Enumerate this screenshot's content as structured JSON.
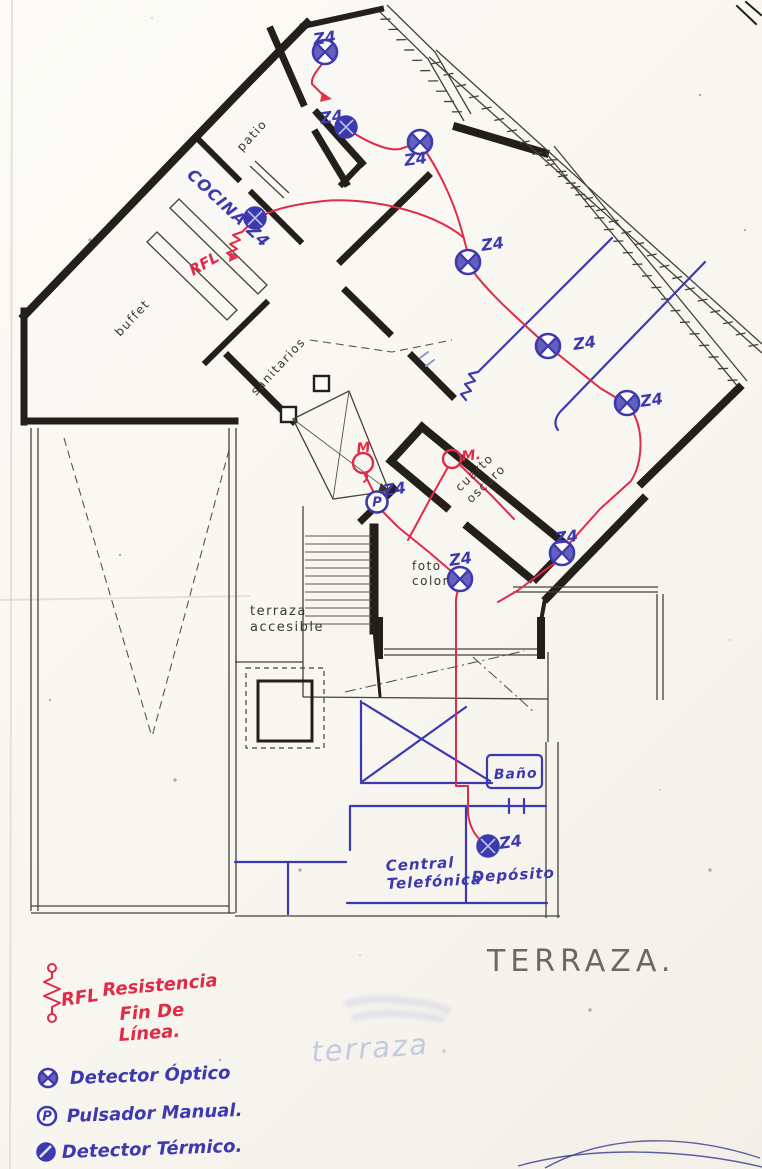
{
  "colors": {
    "wall": "#241f1a",
    "red_ink": "#e02b47",
    "blue_ink": "#3d39ae",
    "pencil": "#55504a",
    "faint_blue": "#a3b0d6"
  },
  "titles": {
    "terraza_pencil": "TERRAZA.",
    "terraza_faint": "terraza ."
  },
  "rooms": [
    {
      "name": "patio",
      "lines": [
        "patio"
      ],
      "x": 242,
      "y": 152,
      "rot": -47,
      "cls": "room",
      "size": 12,
      "lh": 14
    },
    {
      "name": "cocina",
      "lines": [
        "COCINA Z4"
      ],
      "x": 186,
      "y": 176,
      "rot": 43,
      "cls": "room-blue",
      "size": 16,
      "lh": 18
    },
    {
      "name": "buffet",
      "lines": [
        "buffet"
      ],
      "x": 120,
      "y": 337,
      "rot": -47,
      "cls": "room",
      "size": 12,
      "lh": 14
    },
    {
      "name": "sanitarios",
      "lines": [
        "sanitarios"
      ],
      "x": 256,
      "y": 396,
      "rot": -47,
      "cls": "room",
      "size": 12,
      "lh": 14
    },
    {
      "name": "cuarto-oscuro",
      "lines": [
        "cuarto",
        "oscuro"
      ],
      "x": 460,
      "y": 492,
      "rot": -44,
      "cls": "room",
      "size": 12,
      "lh": 16
    },
    {
      "name": "foto-color",
      "lines": [
        "foto",
        "color"
      ],
      "x": 412,
      "y": 570,
      "rot": 0,
      "cls": "room",
      "size": 12,
      "lh": 15
    },
    {
      "name": "terraza-accesible",
      "lines": [
        "terraza",
        "accesible"
      ],
      "x": 250,
      "y": 615,
      "rot": 0,
      "cls": "room",
      "size": 13,
      "lh": 16
    },
    {
      "name": "bano",
      "lines": [
        "Baño"
      ],
      "x": 494,
      "y": 779,
      "rot": -2,
      "cls": "room-blue",
      "size": 14,
      "lh": 16
    },
    {
      "name": "central-telefonica",
      "lines": [
        "Central",
        "Telefónica"
      ],
      "x": 386,
      "y": 871,
      "rot": -3,
      "cls": "room-blue",
      "size": 15,
      "lh": 18
    },
    {
      "name": "deposito",
      "lines": [
        "Depósito"
      ],
      "x": 472,
      "y": 882,
      "rot": -3,
      "cls": "room-blue",
      "size": 15,
      "lh": 18
    }
  ],
  "detectors": [
    {
      "type": "optical",
      "x": 325,
      "y": 52,
      "zone": "Z4",
      "zx": 314,
      "zy": 45
    },
    {
      "type": "solid",
      "x": 346,
      "y": 127,
      "zone": "Z4",
      "zx": 321,
      "zy": 124
    },
    {
      "type": "optical",
      "x": 420,
      "y": 142,
      "zone": "Z4",
      "zx": 405,
      "zy": 166
    },
    {
      "type": "solid",
      "x": 255,
      "y": 218,
      "zone": "",
      "zx": 0,
      "zy": 0
    },
    {
      "type": "optical",
      "x": 468,
      "y": 262,
      "zone": "Z4",
      "zx": 482,
      "zy": 251
    },
    {
      "type": "optical",
      "x": 548,
      "y": 346,
      "zone": "Z4",
      "zx": 574,
      "zy": 350
    },
    {
      "type": "optical",
      "x": 627,
      "y": 403,
      "zone": "Z4",
      "zx": 641,
      "zy": 407
    },
    {
      "type": "optical",
      "x": 562,
      "y": 553,
      "zone": "Z4",
      "zx": 556,
      "zy": 544
    },
    {
      "type": "optical",
      "x": 460,
      "y": 579,
      "zone": "Z4",
      "zx": 450,
      "zy": 566
    },
    {
      "type": "solid",
      "x": 488,
      "y": 846,
      "zone": "Z4",
      "zx": 500,
      "zy": 849
    },
    {
      "type": "pulsador",
      "x": 377,
      "y": 502,
      "zone": "Z4",
      "zx": 384,
      "zy": 496
    }
  ],
  "red_marks": [
    {
      "type": "circle-tail",
      "x": 363,
      "y": 463,
      "label": "M",
      "lx": 357,
      "ly": 453
    },
    {
      "type": "circle",
      "x": 452,
      "y": 459,
      "label": "M.",
      "lx": 462,
      "ly": 461
    }
  ],
  "rfl_note": {
    "label": "RFL",
    "x": 193,
    "y": 276,
    "rot": -30
  },
  "legend": {
    "items": [
      {
        "name": "rfl",
        "symbol": "rfl",
        "color": "red",
        "sx": 52,
        "sy": 996,
        "code": "RFL",
        "cx": 62,
        "cy": 1006,
        "lines": [
          {
            "t": "Resistencia",
            "x": 103,
            "y": 996,
            "r": -5
          },
          {
            "t": "Fin De",
            "x": 120,
            "y": 1020,
            "r": -4
          },
          {
            "t": "Línea.",
            "x": 119,
            "y": 1041,
            "r": -4
          }
        ]
      },
      {
        "name": "detector-optico",
        "symbol": "circle-x",
        "color": "blue",
        "sx": 48,
        "sy": 1078,
        "lines": [
          {
            "t": "Detector Óptico",
            "x": 70,
            "y": 1084,
            "r": -2
          }
        ]
      },
      {
        "name": "pulsador-manual",
        "symbol": "circle-p",
        "color": "blue",
        "sx": 47,
        "sy": 1116,
        "lines": [
          {
            "t": "Pulsador Manual.",
            "x": 67,
            "y": 1122,
            "r": -2
          }
        ]
      },
      {
        "name": "detector-termico",
        "symbol": "circle-half",
        "color": "blue",
        "sx": 46,
        "sy": 1152,
        "lines": [
          {
            "t": "Detector Térmico.",
            "x": 62,
            "y": 1158,
            "r": -2
          }
        ]
      }
    ]
  }
}
